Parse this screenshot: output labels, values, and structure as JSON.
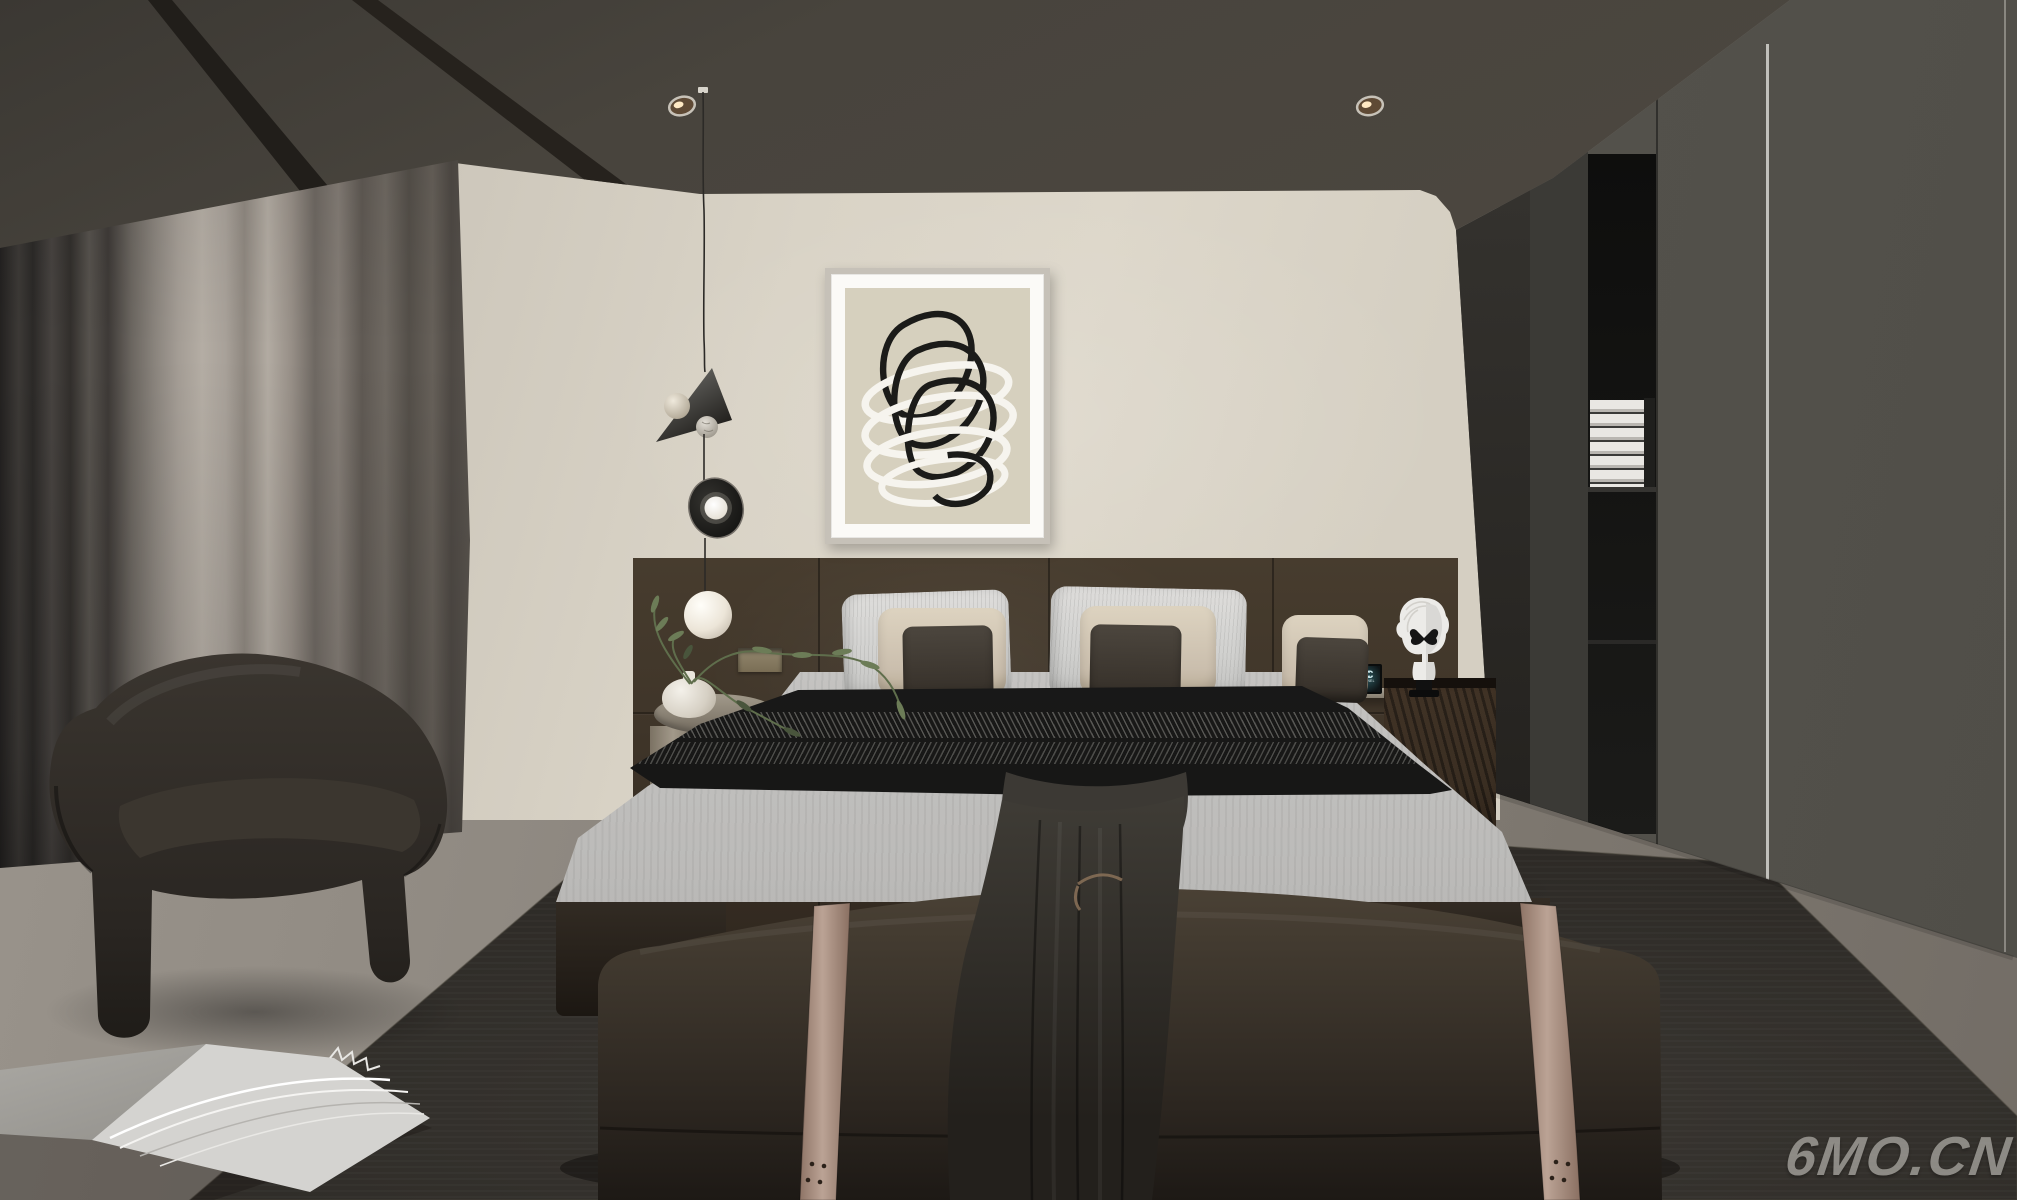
{
  "watermark": {
    "text": "6MO.CN"
  },
  "decor": {
    "chanel_monogram": "CC",
    "chanel_label": "CHANEL"
  },
  "palette": {
    "floor": "#87817a",
    "rug": "#35322d",
    "ceiling": "#48443d",
    "wall": "#d9d3c6",
    "curtain_light": "#b4ada4",
    "headboard": "#3f3529",
    "right_wall": "#55534d",
    "niche": "#141413",
    "nightstand": "#32281e",
    "duvet": "#cdccca",
    "throw": "#1a1a19",
    "pillow_white": "#d0d0ce",
    "pillow_beige": "#cabead",
    "pillow_brown": "#3a342d",
    "bench": "#3b342b",
    "strap": "#b29a8c",
    "blanket": "#2f2c27",
    "armchair": "#2f2b26",
    "art_bg": "#d6d0be",
    "art_black": "#1b1b19",
    "art_white": "#f6f4ee",
    "bust": "#ecebe8",
    "plant": "#5f6e4c",
    "watermark": "#a6a49e"
  },
  "scene_objects": [
    "bedroom 3d render",
    "double bed",
    "upholstered headboard",
    "foot bench with straps",
    "draped blanket",
    "pendant mobile lamp",
    "framed abstract line art",
    "gray curtains",
    "velvet loveseat",
    "round side table with plant",
    "wood nightstand",
    "bust sculpture with butterfly",
    "wardrobe with book niche",
    "dark area rug",
    "open magazine on floor",
    "ceiling spotlights"
  ]
}
